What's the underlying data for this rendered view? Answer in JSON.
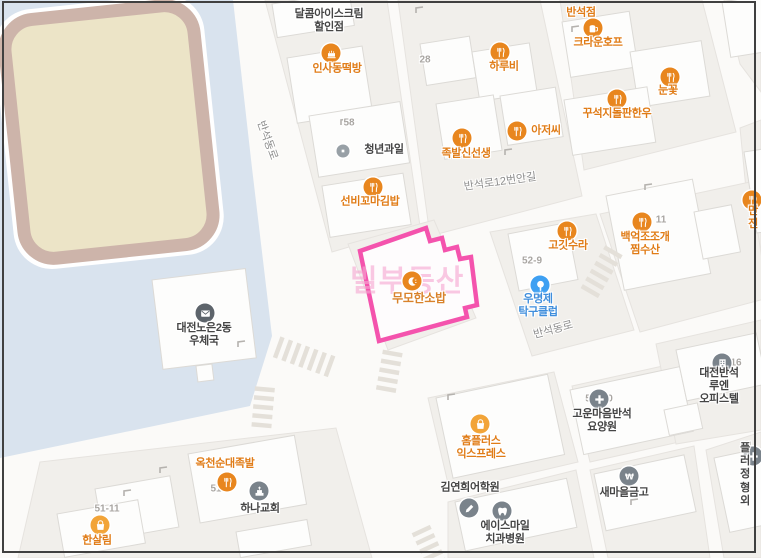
{
  "map": {
    "app": "korean-map-view",
    "colors": {
      "highlight_pink": "#f453ad",
      "poi_orange": "#e8861e",
      "poi_yellow": "#f2a438",
      "poi_blue": "#3ea0f2",
      "poi_gray": "#7a838b",
      "text_orange": "#e07c17",
      "text_dark": "#454545",
      "text_blue": "#3f8edc",
      "campus_blue": "#d9e3ee",
      "field_beige": "#ece4c7",
      "track_brown": "#cdb4aa"
    },
    "selected": {
      "name": "무모한소밥",
      "faded_label": "빌부동산"
    },
    "pois": [
      {
        "label": "달콤아이스크림\n할인점",
        "icon": "none"
      },
      {
        "label": "반석점",
        "icon": "none"
      },
      {
        "label": "인사동떡방",
        "icon": "cake"
      },
      {
        "label": "크라운호프",
        "icon": "beer"
      },
      {
        "label": "하루비",
        "icon": "fork-knife"
      },
      {
        "label": "눈꽃",
        "icon": "fork-knife"
      },
      {
        "label": "꾸석지돌판한우",
        "icon": "fork-knife"
      },
      {
        "label": "족발신선생",
        "icon": "fork-knife"
      },
      {
        "label": "아저씨",
        "icon": "fork-knife"
      },
      {
        "label": "청년과일",
        "icon": "dot"
      },
      {
        "label": "선비꼬마김밥",
        "icon": "fork-knife"
      },
      {
        "label": "고깃수라",
        "icon": "fork-knife"
      },
      {
        "label": "우명제\n탁구클럽",
        "icon": "table-tennis"
      },
      {
        "label": "백억조조개\n찜수산",
        "icon": "fork-knife"
      },
      {
        "label": "만전",
        "icon": "fork-knife"
      },
      {
        "label": "무모한소밥",
        "icon": "crescent"
      },
      {
        "label": "대전노은2동\n우체국",
        "icon": "mail"
      },
      {
        "label": "옥천순대족발",
        "icon": "fork-knife"
      },
      {
        "label": "하나교회",
        "icon": "church"
      },
      {
        "label": "한살림",
        "icon": "store"
      },
      {
        "label": "홈플러스\n익스프레스",
        "icon": "store"
      },
      {
        "label": "고운마음반석\n요양원",
        "icon": "medical-cross"
      },
      {
        "label": "김연희어학원",
        "icon": "pencil"
      },
      {
        "label": "에이스마일\n치과병원",
        "icon": "tooth"
      },
      {
        "label": "새마을금고",
        "icon": "won"
      },
      {
        "label": "대전반석루엔\n오피스텔",
        "icon": "building"
      },
      {
        "label": "플러\n정형외",
        "icon": "medical-cross"
      }
    ],
    "road_labels": [
      "반석동로",
      "반석로12번안길",
      "반석동로"
    ],
    "lot_numbers": [
      "28",
      "58",
      "11",
      "52-9",
      "51",
      "51-11",
      "16",
      "14",
      "5",
      "0"
    ]
  }
}
